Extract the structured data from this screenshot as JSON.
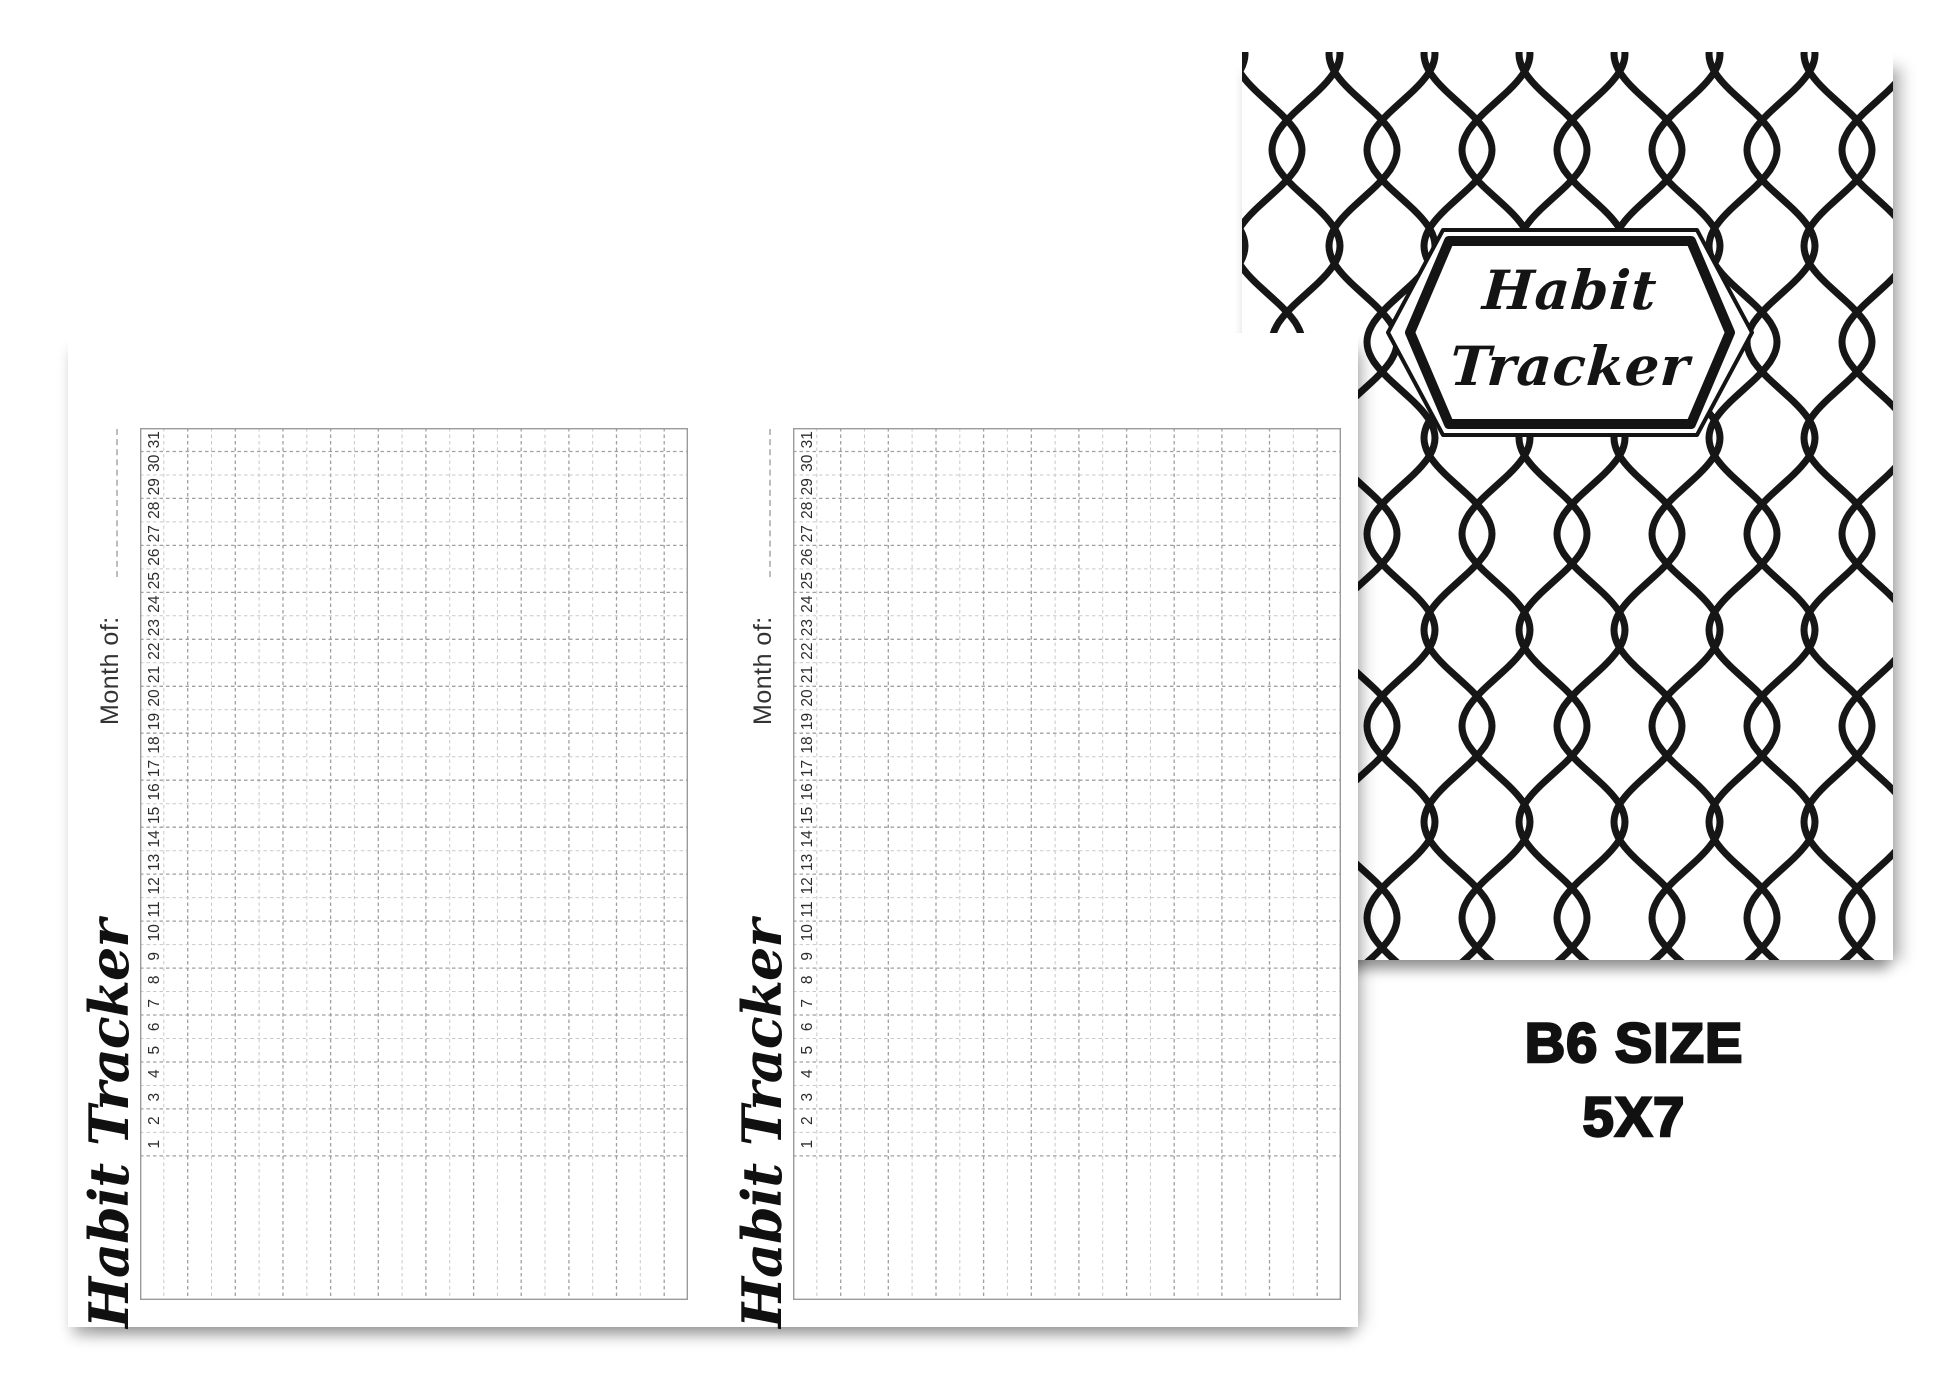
{
  "cover": {
    "badge_title_line1": "Habit",
    "badge_title_line2": "Tracker",
    "pattern_name": "chain-link-lattice"
  },
  "pages": [
    {
      "script_title": "Habit Tracker",
      "month_label": "Month of:"
    },
    {
      "script_title": "Habit Tracker",
      "month_label": "Month of:"
    }
  ],
  "day_numbers": [
    1,
    2,
    3,
    4,
    5,
    6,
    7,
    8,
    9,
    10,
    11,
    12,
    13,
    14,
    15,
    16,
    17,
    18,
    19,
    20,
    21,
    22,
    23,
    24,
    25,
    26,
    27,
    28,
    29,
    30,
    31
  ],
  "caption": {
    "size_line1": "B6 SIZE",
    "size_line2": "5X7"
  },
  "colors": {
    "ink": "#161616",
    "number_ink": "#2c2c2c",
    "grid_border": "#9b9b9b",
    "grid_strong": "#a0a0a0",
    "grid_weak": "#c9c9c9",
    "month_line": "#bdbdbd"
  }
}
